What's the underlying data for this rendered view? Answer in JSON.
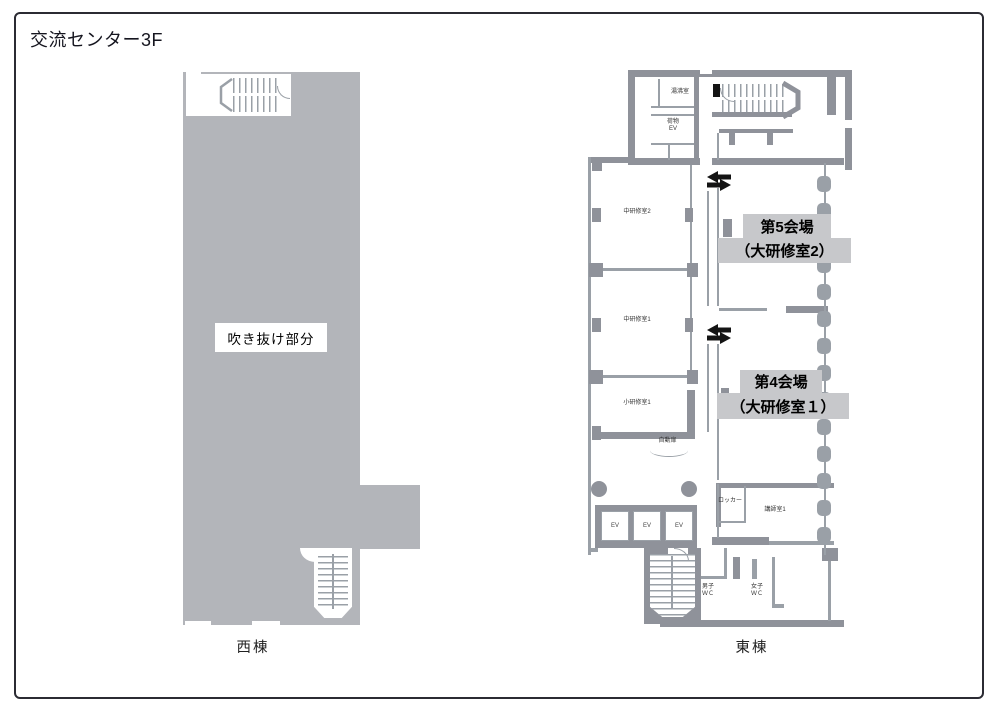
{
  "title": "交流センター3F",
  "west_building": {
    "name": "西棟",
    "atrium_label": "吹き抜け部分"
  },
  "east_building": {
    "name": "東棟",
    "rooms": {
      "hot_water_room": "湯沸室",
      "cargo_ev": {
        "line1": "荷物",
        "line2": "EV"
      },
      "mid_training_room_2": "中研修室2",
      "mid_training_room_1": "中研修室1",
      "small_training_room_1": "小研修室1",
      "auto_door": "自動扉",
      "locker": "ロッカー",
      "instructor_room_1": "講師室1",
      "elevator": "EV",
      "mens_wc": {
        "line1": "男子",
        "line2": "ＷＣ"
      },
      "womens_wc": {
        "line1": "女子",
        "line2": "ＷＣ"
      }
    },
    "venues": [
      {
        "line1": "第5会場",
        "line2": "（大研修室2）"
      },
      {
        "line1": "第4会場",
        "line2": "（大研修室１）"
      }
    ]
  },
  "colors": {
    "wall": "#8f929a",
    "wall_light": "#9aa0a7",
    "west_fill": "#b3b5ba",
    "venue_highlight": "#c7c8cb",
    "arrow": "#141414",
    "frame_border": "#2b2b33"
  }
}
